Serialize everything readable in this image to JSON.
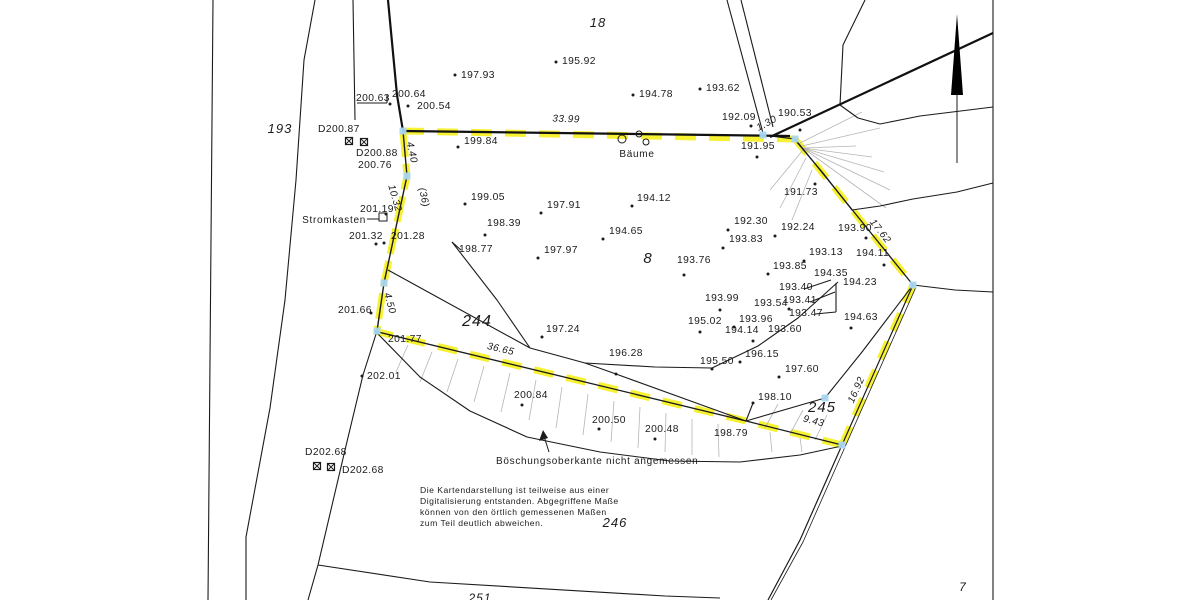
{
  "map": {
    "colors": {
      "line": "#1b1b1b",
      "hatch_gray": "#b5b5b5",
      "boundary_highlight": "#f4ee00",
      "vertex_marker": "#a9d6f2",
      "background": "#ffffff"
    }
  },
  "parcels": [
    {
      "label": "193",
      "x": 280,
      "y": 133,
      "size": 13
    },
    {
      "label": "18",
      "x": 598,
      "y": 27,
      "size": 13
    },
    {
      "label": "8",
      "x": 648,
      "y": 263,
      "size": 15
    },
    {
      "label": "244",
      "x": 477,
      "y": 326,
      "size": 16
    },
    {
      "label": "245",
      "x": 822,
      "y": 412,
      "size": 15
    },
    {
      "label": "246",
      "x": 615,
      "y": 527,
      "size": 13
    },
    {
      "label": "7",
      "x": 963,
      "y": 591,
      "size": 12
    },
    {
      "label": "251",
      "x": 480,
      "y": 602,
      "size": 12
    }
  ],
  "elevation_points": [
    {
      "label": "197.93",
      "x": 461,
      "y": 78,
      "dot": [
        455,
        75
      ]
    },
    {
      "label": "195.92",
      "x": 562,
      "y": 64,
      "dot": [
        556,
        62
      ]
    },
    {
      "label": "194.78",
      "x": 639,
      "y": 97,
      "dot": [
        633,
        95
      ]
    },
    {
      "label": "193.62",
      "x": 706,
      "y": 91,
      "dot": [
        700,
        89
      ]
    },
    {
      "label": "192.09",
      "x": 722,
      "y": 120,
      "dot": [
        751,
        126
      ]
    },
    {
      "label": "190.53",
      "x": 778,
      "y": 116,
      "dot": [
        800,
        130
      ]
    },
    {
      "label": "191.95",
      "x": 741,
      "y": 149,
      "dot": [
        757,
        157
      ]
    },
    {
      "label": "191.73",
      "x": 784,
      "y": 195,
      "dot": [
        815,
        184
      ]
    },
    {
      "label": "200.63",
      "x": 356,
      "y": 101
    },
    {
      "label": "200.64",
      "x": 392,
      "y": 97,
      "dot": [
        390,
        104
      ]
    },
    {
      "label": "200.54",
      "x": 417,
      "y": 109,
      "dot": [
        408,
        106
      ]
    },
    {
      "label": "D200.87",
      "x": 318,
      "y": 132
    },
    {
      "label": "D200.88",
      "x": 356,
      "y": 156
    },
    {
      "label": "200.76",
      "x": 358,
      "y": 168
    },
    {
      "label": "199.84",
      "x": 464,
      "y": 144,
      "dot": [
        458,
        147
      ]
    },
    {
      "label": "199.05",
      "x": 471,
      "y": 200,
      "dot": [
        465,
        204
      ]
    },
    {
      "label": "197.91",
      "x": 547,
      "y": 208,
      "dot": [
        541,
        213
      ]
    },
    {
      "label": "194.12",
      "x": 637,
      "y": 201,
      "dot": [
        632,
        206
      ]
    },
    {
      "label": "198.39",
      "x": 487,
      "y": 226,
      "dot": [
        485,
        235
      ]
    },
    {
      "label": "194.65",
      "x": 609,
      "y": 234,
      "dot": [
        603,
        239
      ]
    },
    {
      "label": "198.77",
      "x": 459,
      "y": 252
    },
    {
      "label": "197.97",
      "x": 544,
      "y": 253,
      "dot": [
        538,
        258
      ]
    },
    {
      "label": "193.76",
      "x": 677,
      "y": 263,
      "dot": [
        684,
        275
      ]
    },
    {
      "label": "192.30",
      "x": 734,
      "y": 224,
      "dot": [
        728,
        230
      ]
    },
    {
      "label": "192.24",
      "x": 781,
      "y": 230,
      "dot": [
        775,
        236
      ]
    },
    {
      "label": "193.83",
      "x": 729,
      "y": 242,
      "dot": [
        723,
        248
      ]
    },
    {
      "label": "193.13",
      "x": 809,
      "y": 255,
      "dot": [
        804,
        261
      ]
    },
    {
      "label": "193.90",
      "x": 838,
      "y": 231,
      "dot": [
        866,
        238
      ]
    },
    {
      "label": "194.11",
      "x": 856,
      "y": 256,
      "dot": [
        884,
        265
      ]
    },
    {
      "label": "193.85",
      "x": 773,
      "y": 269,
      "dot": [
        768,
        274
      ]
    },
    {
      "label": "194.35",
      "x": 814,
      "y": 276
    },
    {
      "label": "194.23",
      "x": 843,
      "y": 285
    },
    {
      "label": "193.40",
      "x": 779,
      "y": 290
    },
    {
      "label": "193.41",
      "x": 783,
      "y": 303
    },
    {
      "label": "193.54",
      "x": 754,
      "y": 306,
      "dot": [
        789,
        309
      ]
    },
    {
      "label": "193.47",
      "x": 789,
      "y": 316
    },
    {
      "label": "193.99",
      "x": 705,
      "y": 301,
      "dot": [
        720,
        310
      ]
    },
    {
      "label": "194.63",
      "x": 844,
      "y": 320,
      "dot": [
        851,
        328
      ]
    },
    {
      "label": "195.02",
      "x": 688,
      "y": 324,
      "dot": [
        700,
        332
      ]
    },
    {
      "label": "193.96",
      "x": 739,
      "y": 322,
      "dot": [
        734,
        327
      ]
    },
    {
      "label": "194.14",
      "x": 725,
      "y": 333,
      "dot": [
        753,
        341
      ]
    },
    {
      "label": "193.60",
      "x": 768,
      "y": 332
    },
    {
      "label": "197.24",
      "x": 546,
      "y": 332,
      "dot": [
        542,
        337
      ]
    },
    {
      "label": "196.28",
      "x": 609,
      "y": 356,
      "dot": [
        616,
        374
      ]
    },
    {
      "label": "195.50",
      "x": 700,
      "y": 364,
      "dot": [
        712,
        369
      ]
    },
    {
      "label": "196.15",
      "x": 745,
      "y": 357,
      "dot": [
        740,
        362
      ]
    },
    {
      "label": "197.60",
      "x": 785,
      "y": 372,
      "dot": [
        779,
        377
      ]
    },
    {
      "label": "198.10",
      "x": 758,
      "y": 400,
      "dot": [
        753,
        403
      ]
    },
    {
      "label": "200.84",
      "x": 514,
      "y": 398,
      "dot": [
        522,
        405
      ]
    },
    {
      "label": "200.50",
      "x": 592,
      "y": 423,
      "dot": [
        599,
        429
      ]
    },
    {
      "label": "200.48",
      "x": 645,
      "y": 432,
      "dot": [
        655,
        439
      ]
    },
    {
      "label": "198.79",
      "x": 714,
      "y": 436
    },
    {
      "label": "201.19",
      "x": 360,
      "y": 212,
      "dot": [
        386,
        214
      ]
    },
    {
      "label": "201.32",
      "x": 349,
      "y": 239,
      "dot": [
        376,
        244
      ]
    },
    {
      "label": "201.28",
      "x": 391,
      "y": 239,
      "dot": [
        384,
        243
      ]
    },
    {
      "label": "201.66",
      "x": 338,
      "y": 313,
      "dot": [
        371,
        313
      ]
    },
    {
      "label": "201.77",
      "x": 388,
      "y": 342
    },
    {
      "label": "202.01",
      "x": 367,
      "y": 379,
      "dot": [
        362,
        376
      ]
    },
    {
      "label": "D202.68",
      "x": 305,
      "y": 455
    },
    {
      "label": "D202.68",
      "x": 342,
      "y": 473
    }
  ],
  "dimensions": [
    {
      "label": "33.99",
      "x": 566,
      "y": 122,
      "rot": 2
    },
    {
      "label": "4.40",
      "x": 409,
      "y": 153,
      "rot": 78
    },
    {
      "label": "10.32",
      "x": 392,
      "y": 199,
      "rot": 74
    },
    {
      "label": "(36)",
      "x": 421,
      "y": 198,
      "rot": 78
    },
    {
      "label": "4.50",
      "x": 387,
      "y": 304,
      "rot": 75
    },
    {
      "label": "1.30",
      "x": 768,
      "y": 126,
      "rot": -28
    },
    {
      "label": "17.62",
      "x": 878,
      "y": 233,
      "rot": 52
    },
    {
      "label": "16.92",
      "x": 859,
      "y": 391,
      "rot": -66
    },
    {
      "label": "9.43",
      "x": 813,
      "y": 424,
      "rot": 14
    },
    {
      "label": "36.65",
      "x": 500,
      "y": 352,
      "rot": 13
    }
  ],
  "vertex_markers": [
    [
      403,
      131
    ],
    [
      407,
      176
    ],
    [
      384,
      283
    ],
    [
      377,
      331
    ],
    [
      763,
      135
    ],
    [
      795,
      139
    ],
    [
      913,
      285
    ],
    [
      842,
      445
    ],
    [
      825,
      398
    ]
  ],
  "boundary_stones": [
    [
      349,
      141
    ],
    [
      364,
      142
    ],
    [
      317,
      466
    ],
    [
      331,
      467
    ]
  ],
  "tree_circles": [
    [
      622,
      139,
      4
    ],
    [
      639,
      134,
      3
    ],
    [
      646,
      142,
      3
    ]
  ],
  "annotations": {
    "baeume": "Bäume",
    "stromkasten": "Stromkasten",
    "boeschung": "Böschungsoberkante nicht angemessen",
    "note_lines": [
      "Die Kartendarstellung ist teilweise aus einer",
      "Digitalisierung entstanden. Abgegriffene Maße",
      "können von den örtlich gemessenen Maßen",
      "zum Teil deutlich abweichen."
    ]
  }
}
